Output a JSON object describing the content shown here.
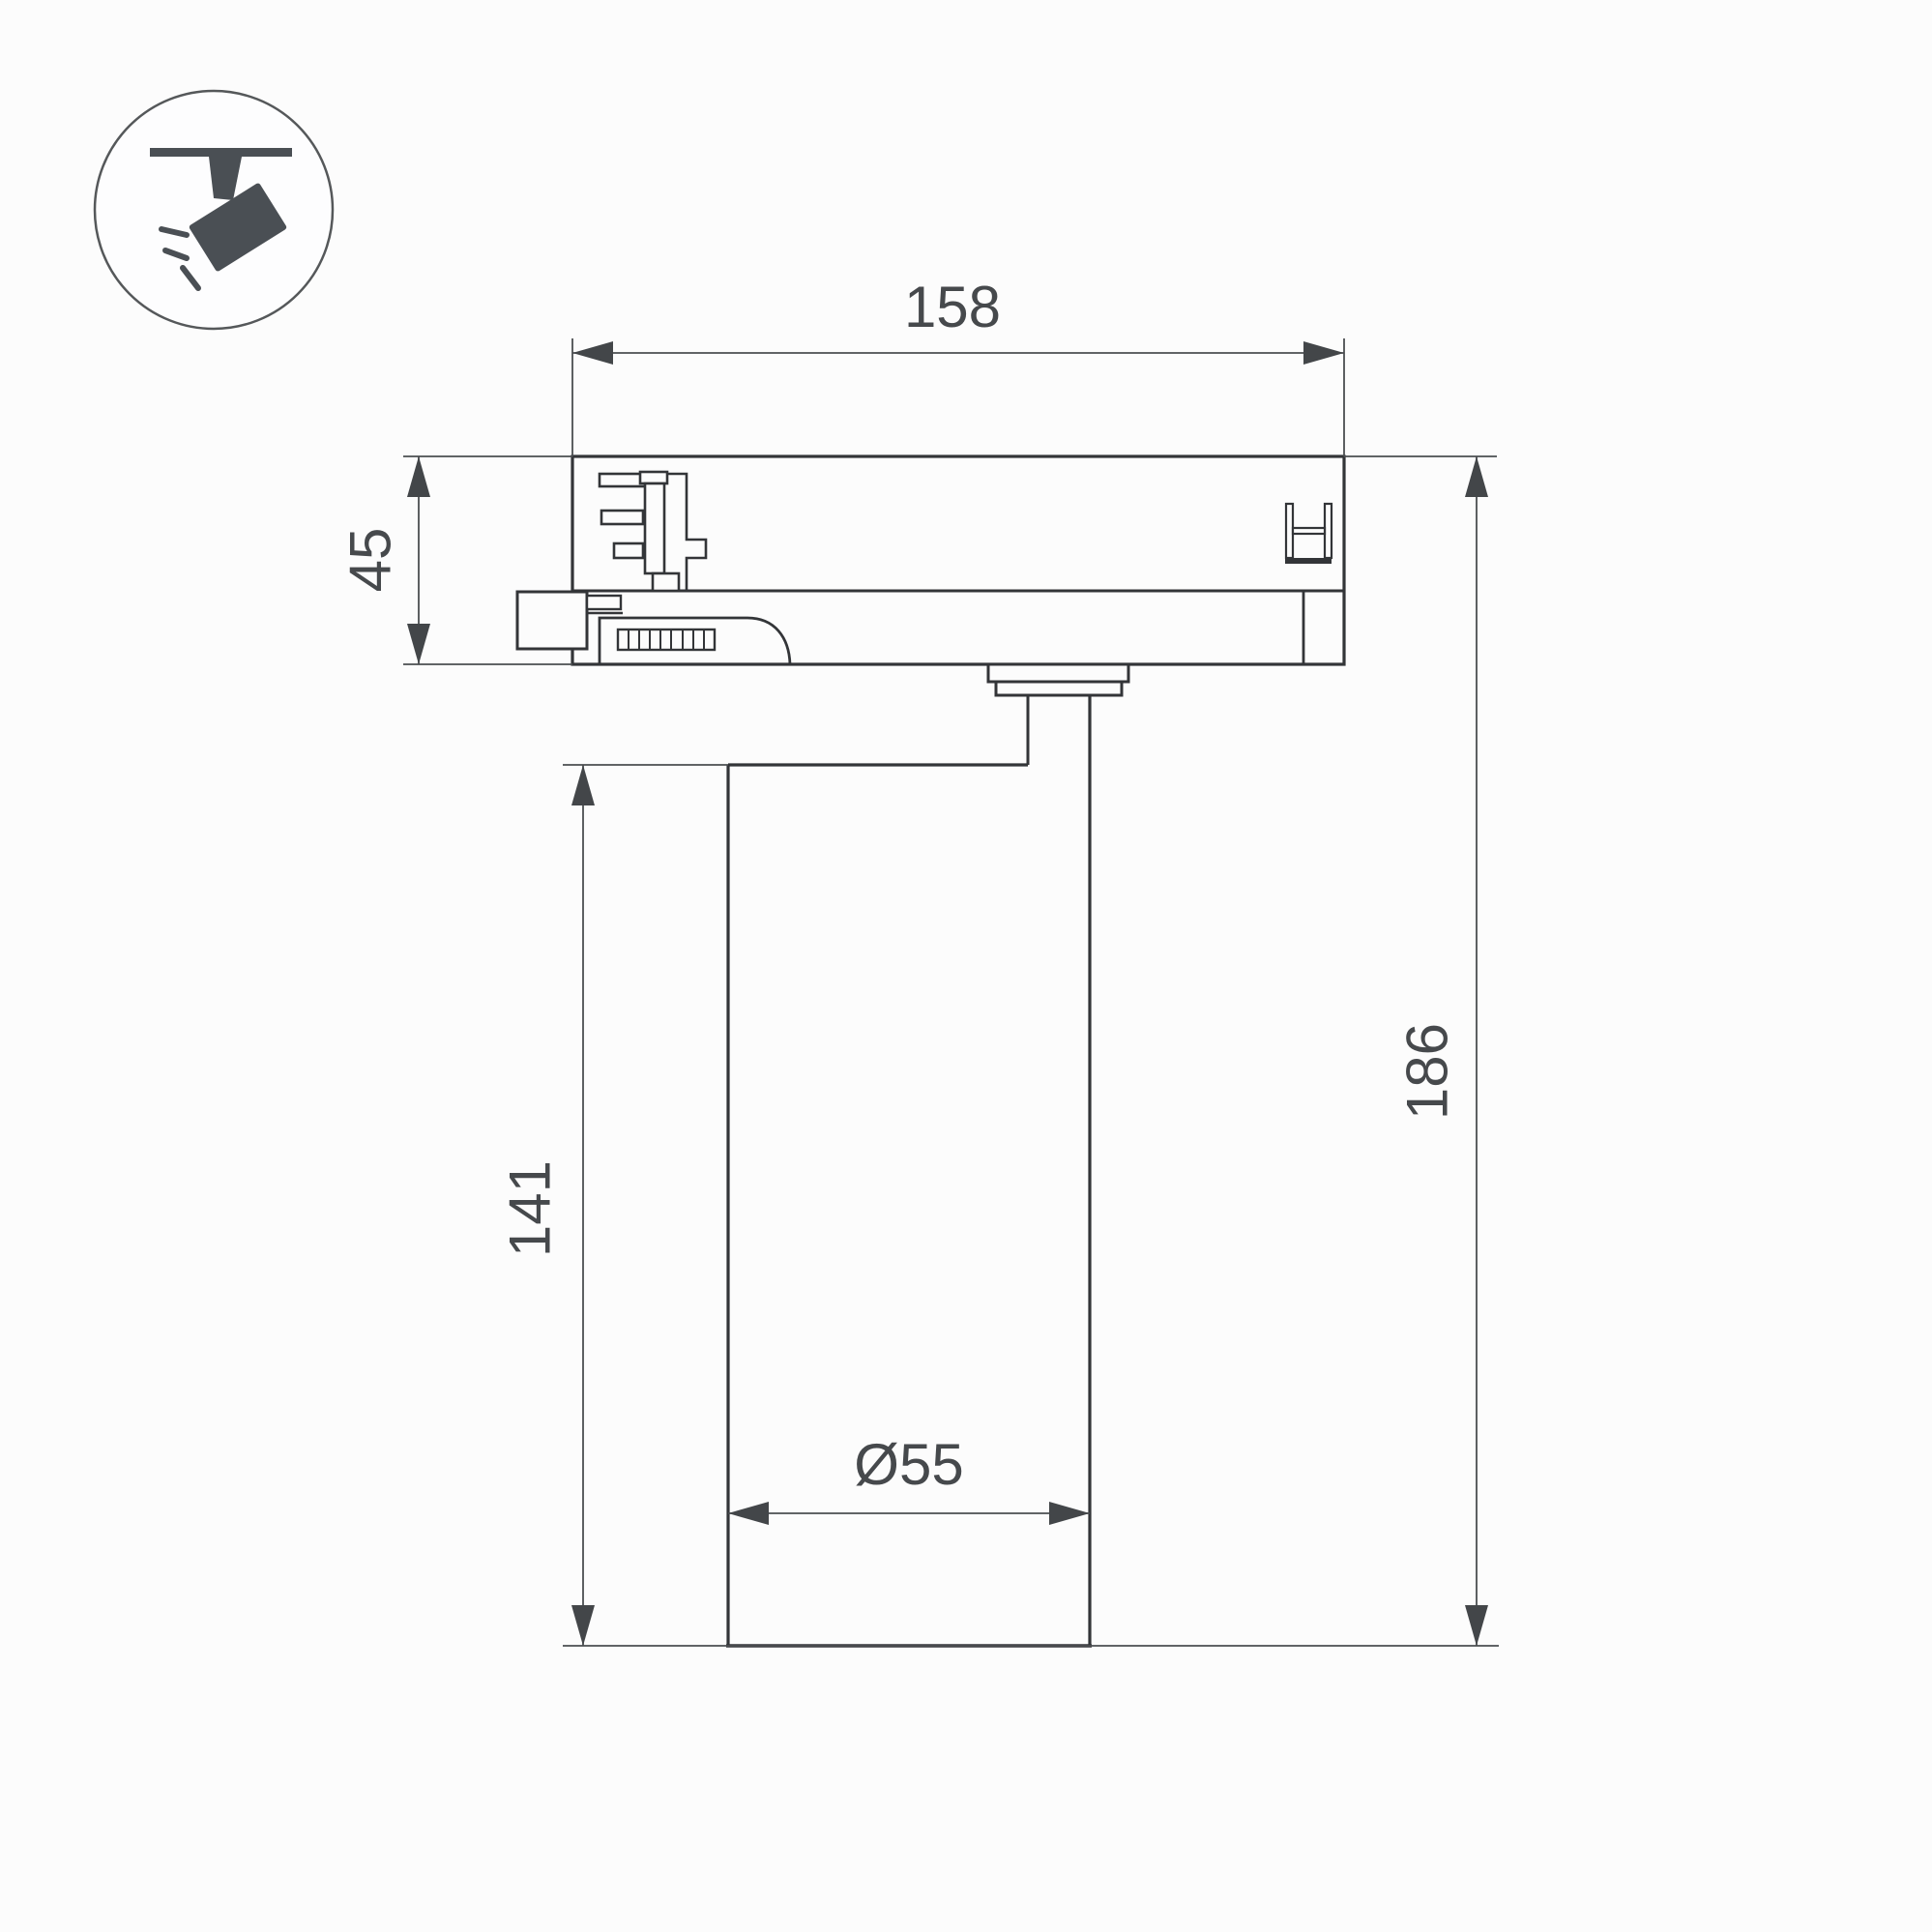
{
  "icon": {
    "name": "track-spotlight-icon"
  },
  "dimensions": {
    "track_adapter_width": "158",
    "track_adapter_height": "45",
    "body_height": "141",
    "overall_height": "186",
    "body_diameter": "Ø55"
  }
}
